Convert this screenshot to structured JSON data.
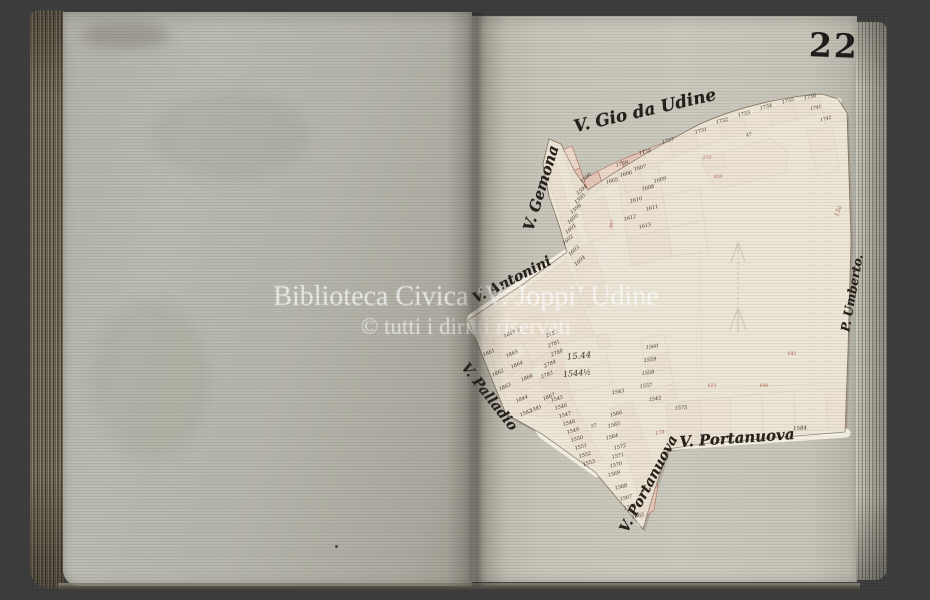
{
  "photo": {
    "background_color": "#3c3c3c"
  },
  "book": {
    "page_number": "22"
  },
  "watermark": {
    "line1": "Biblioteca Civica ‘V. Joppi’ Udine",
    "line2": "© tutti i diritti riservati",
    "color": "rgba(255,255,255,0.62)",
    "color2": "rgba(255,255,255,0.50)"
  },
  "colors": {
    "background": "#3c3c3c",
    "left_page": "#b6b5ab",
    "right_page": "#c7c4b9",
    "map_paper": "#ece6d7",
    "street_white": "#f4f0e5",
    "building_fill": "#e5c6b6",
    "building_fill_light": "#eed8ca",
    "building_stroke": "#a8715f",
    "ink": "#3e352b",
    "red_ink": "#b2604f",
    "page_number_color": "#1d1c1a"
  },
  "map": {
    "north_arrow": "north-arrow",
    "street_labels": [
      {
        "t": "V. Gio da Udine",
        "x": 645,
        "y": 111,
        "r": -13,
        "s": 17
      },
      {
        "t": "V. Gemona",
        "x": 541,
        "y": 188,
        "r": -73,
        "s": 15
      },
      {
        "t": "V. Antonini",
        "x": 512,
        "y": 280,
        "r": -27,
        "s": 14
      },
      {
        "t": "V. Palladio",
        "x": 489,
        "y": 397,
        "r": 52,
        "s": 14
      },
      {
        "t": "V. Portanuova",
        "x": 649,
        "y": 484,
        "r": -62,
        "s": 14
      },
      {
        "t": "V. Portanuova",
        "x": 737,
        "y": 438,
        "r": -4,
        "s": 15
      },
      {
        "t": "P. Umberto.",
        "x": 852,
        "y": 293,
        "r": -80,
        "s": 12
      }
    ],
    "parcel_labels": [
      {
        "t": "1739",
        "x": 622,
        "y": 164,
        "r": -14,
        "s": 5
      },
      {
        "t": "1738",
        "x": 645,
        "y": 152,
        "r": -14,
        "s": 5
      },
      {
        "t": "1737",
        "x": 668,
        "y": 141,
        "r": -14,
        "s": 5
      },
      {
        "t": "1731",
        "x": 701,
        "y": 131,
        "r": -14,
        "s": 5
      },
      {
        "t": "1732",
        "x": 722,
        "y": 121,
        "r": -14,
        "s": 5
      },
      {
        "t": "1733",
        "x": 744,
        "y": 114,
        "r": -14,
        "s": 5
      },
      {
        "t": "1734",
        "x": 766,
        "y": 107,
        "r": -14,
        "s": 5
      },
      {
        "t": "1735",
        "x": 788,
        "y": 101,
        "r": -14,
        "s": 5
      },
      {
        "t": "1736",
        "x": 810,
        "y": 97,
        "r": -14,
        "s": 5
      },
      {
        "t": "47",
        "x": 749,
        "y": 135,
        "r": -14,
        "s": 4.5
      },
      {
        "t": "1741",
        "x": 816,
        "y": 108,
        "r": -14,
        "s": 4.5
      },
      {
        "t": "1742",
        "x": 826,
        "y": 119,
        "r": -14,
        "s": 4.5
      },
      {
        "t": "1596",
        "x": 586,
        "y": 178,
        "r": -42,
        "s": 5
      },
      {
        "t": "1594",
        "x": 582,
        "y": 190,
        "r": -42,
        "s": 5
      },
      {
        "t": "1595",
        "x": 580,
        "y": 199,
        "r": -42,
        "s": 5
      },
      {
        "t": "1598",
        "x": 576,
        "y": 209,
        "r": -42,
        "s": 5
      },
      {
        "t": "1600",
        "x": 573,
        "y": 219,
        "r": -42,
        "s": 5
      },
      {
        "t": "1601",
        "x": 571,
        "y": 229,
        "r": -42,
        "s": 5
      },
      {
        "t": "1602",
        "x": 568,
        "y": 240,
        "r": -42,
        "s": 5
      },
      {
        "t": "1603",
        "x": 574,
        "y": 251,
        "r": -42,
        "s": 5
      },
      {
        "t": "1604",
        "x": 580,
        "y": 261,
        "r": -42,
        "s": 5
      },
      {
        "t": "1605",
        "x": 612,
        "y": 181,
        "r": -14,
        "s": 5
      },
      {
        "t": "1606",
        "x": 626,
        "y": 174,
        "r": -14,
        "s": 5
      },
      {
        "t": "1607",
        "x": 640,
        "y": 168,
        "r": -14,
        "s": 5
      },
      {
        "t": "1608",
        "x": 648,
        "y": 188,
        "r": -14,
        "s": 5
      },
      {
        "t": "1609",
        "x": 660,
        "y": 180,
        "r": -14,
        "s": 5
      },
      {
        "t": "1610",
        "x": 636,
        "y": 200,
        "r": -14,
        "s": 5
      },
      {
        "t": "1611",
        "x": 652,
        "y": 208,
        "r": -14,
        "s": 5
      },
      {
        "t": "1612",
        "x": 630,
        "y": 218,
        "r": -14,
        "s": 5
      },
      {
        "t": "1613",
        "x": 645,
        "y": 226,
        "r": -14,
        "s": 5
      },
      {
        "t": "887",
        "x": 612,
        "y": 224,
        "r": -75,
        "s": 4.5,
        "c": "red"
      },
      {
        "t": "273",
        "x": 707,
        "y": 158,
        "r": 0,
        "s": 4.5,
        "c": "red"
      },
      {
        "t": "616",
        "x": 718,
        "y": 177,
        "r": 0,
        "s": 4.5,
        "c": "red"
      },
      {
        "t": "613",
        "x": 712,
        "y": 386,
        "r": 0,
        "s": 4.5,
        "c": "red"
      },
      {
        "t": "644",
        "x": 764,
        "y": 386,
        "r": 0,
        "s": 4.5,
        "c": "red"
      },
      {
        "t": "645",
        "x": 792,
        "y": 354,
        "r": 0,
        "s": 4.5,
        "c": "red"
      },
      {
        "t": "179",
        "x": 660,
        "y": 433,
        "r": -10,
        "s": 5,
        "c": "red"
      },
      {
        "t": "13a",
        "x": 838,
        "y": 211,
        "r": -70,
        "s": 6,
        "c": "red"
      },
      {
        "t": "1841½",
        "x": 512,
        "y": 333,
        "r": -23,
        "s": 5
      },
      {
        "t": "2782",
        "x": 552,
        "y": 334,
        "r": -23,
        "s": 5
      },
      {
        "t": "2781",
        "x": 554,
        "y": 344,
        "r": -23,
        "s": 5
      },
      {
        "t": "2780",
        "x": 557,
        "y": 353,
        "r": -23,
        "s": 5
      },
      {
        "t": "2784",
        "x": 550,
        "y": 364,
        "r": -23,
        "s": 5
      },
      {
        "t": "2783",
        "x": 547,
        "y": 375,
        "r": -23,
        "s": 5
      },
      {
        "t": "1861",
        "x": 489,
        "y": 353,
        "r": -23,
        "s": 5
      },
      {
        "t": "1865",
        "x": 512,
        "y": 354,
        "r": -23,
        "s": 5
      },
      {
        "t": "1864",
        "x": 517,
        "y": 365,
        "r": -23,
        "s": 5
      },
      {
        "t": "1862",
        "x": 498,
        "y": 373,
        "r": -23,
        "s": 5
      },
      {
        "t": "1863",
        "x": 505,
        "y": 387,
        "r": -23,
        "s": 5
      },
      {
        "t": "1866",
        "x": 527,
        "y": 378,
        "r": -23,
        "s": 5
      },
      {
        "t": "1844",
        "x": 522,
        "y": 399,
        "r": -23,
        "s": 5
      },
      {
        "t": "1867",
        "x": 549,
        "y": 397,
        "r": -23,
        "s": 5
      },
      {
        "t": "1581",
        "x": 536,
        "y": 409,
        "r": -23,
        "s": 5
      },
      {
        "t": "1582",
        "x": 526,
        "y": 413,
        "r": -23,
        "s": 5
      },
      {
        "t": "15.44",
        "x": 579,
        "y": 356,
        "r": -5,
        "s": 8.5
      },
      {
        "t": "1544½",
        "x": 577,
        "y": 373,
        "r": -5,
        "s": 8
      },
      {
        "t": "1545",
        "x": 557,
        "y": 399,
        "r": -16,
        "s": 5
      },
      {
        "t": "1546",
        "x": 561,
        "y": 407,
        "r": -16,
        "s": 5
      },
      {
        "t": "1547",
        "x": 565,
        "y": 415,
        "r": -16,
        "s": 5
      },
      {
        "t": "1548",
        "x": 569,
        "y": 423,
        "r": -16,
        "s": 5
      },
      {
        "t": "1549",
        "x": 573,
        "y": 431,
        "r": -16,
        "s": 5
      },
      {
        "t": "1550",
        "x": 577,
        "y": 439,
        "r": -16,
        "s": 5
      },
      {
        "t": "1551",
        "x": 581,
        "y": 447,
        "r": -16,
        "s": 5
      },
      {
        "t": "1552",
        "x": 585,
        "y": 455,
        "r": -16,
        "s": 5
      },
      {
        "t": "1553",
        "x": 589,
        "y": 463,
        "r": -16,
        "s": 5
      },
      {
        "t": "57",
        "x": 594,
        "y": 426,
        "r": -16,
        "s": 4.5
      },
      {
        "t": "1560",
        "x": 652,
        "y": 347,
        "r": -8,
        "s": 5
      },
      {
        "t": "1559",
        "x": 650,
        "y": 360,
        "r": -8,
        "s": 5
      },
      {
        "t": "1558",
        "x": 648,
        "y": 373,
        "r": -8,
        "s": 5
      },
      {
        "t": "1557",
        "x": 646,
        "y": 386,
        "r": -8,
        "s": 5
      },
      {
        "t": "1543",
        "x": 618,
        "y": 392,
        "r": -10,
        "s": 5
      },
      {
        "t": "1542",
        "x": 655,
        "y": 399,
        "r": -8,
        "s": 5
      },
      {
        "t": "1566",
        "x": 616,
        "y": 414,
        "r": -14,
        "s": 5
      },
      {
        "t": "1565",
        "x": 614,
        "y": 425,
        "r": -14,
        "s": 5
      },
      {
        "t": "1564",
        "x": 612,
        "y": 437,
        "r": -14,
        "s": 5
      },
      {
        "t": "1572",
        "x": 620,
        "y": 447,
        "r": -14,
        "s": 5
      },
      {
        "t": "1571",
        "x": 618,
        "y": 456,
        "r": -14,
        "s": 5
      },
      {
        "t": "1570",
        "x": 616,
        "y": 465,
        "r": -14,
        "s": 5
      },
      {
        "t": "1569",
        "x": 614,
        "y": 474,
        "r": -14,
        "s": 5
      },
      {
        "t": "1568",
        "x": 621,
        "y": 487,
        "r": -14,
        "s": 5
      },
      {
        "t": "1567",
        "x": 626,
        "y": 498,
        "r": -14,
        "s": 5
      },
      {
        "t": "1561",
        "x": 630,
        "y": 507,
        "r": -14,
        "s": 5
      },
      {
        "t": "1562",
        "x": 638,
        "y": 516,
        "r": -14,
        "s": 5
      },
      {
        "t": "1575",
        "x": 681,
        "y": 408,
        "r": -3,
        "s": 5
      },
      {
        "t": "1584",
        "x": 800,
        "y": 428,
        "r": -3,
        "s": 5.5
      }
    ]
  }
}
